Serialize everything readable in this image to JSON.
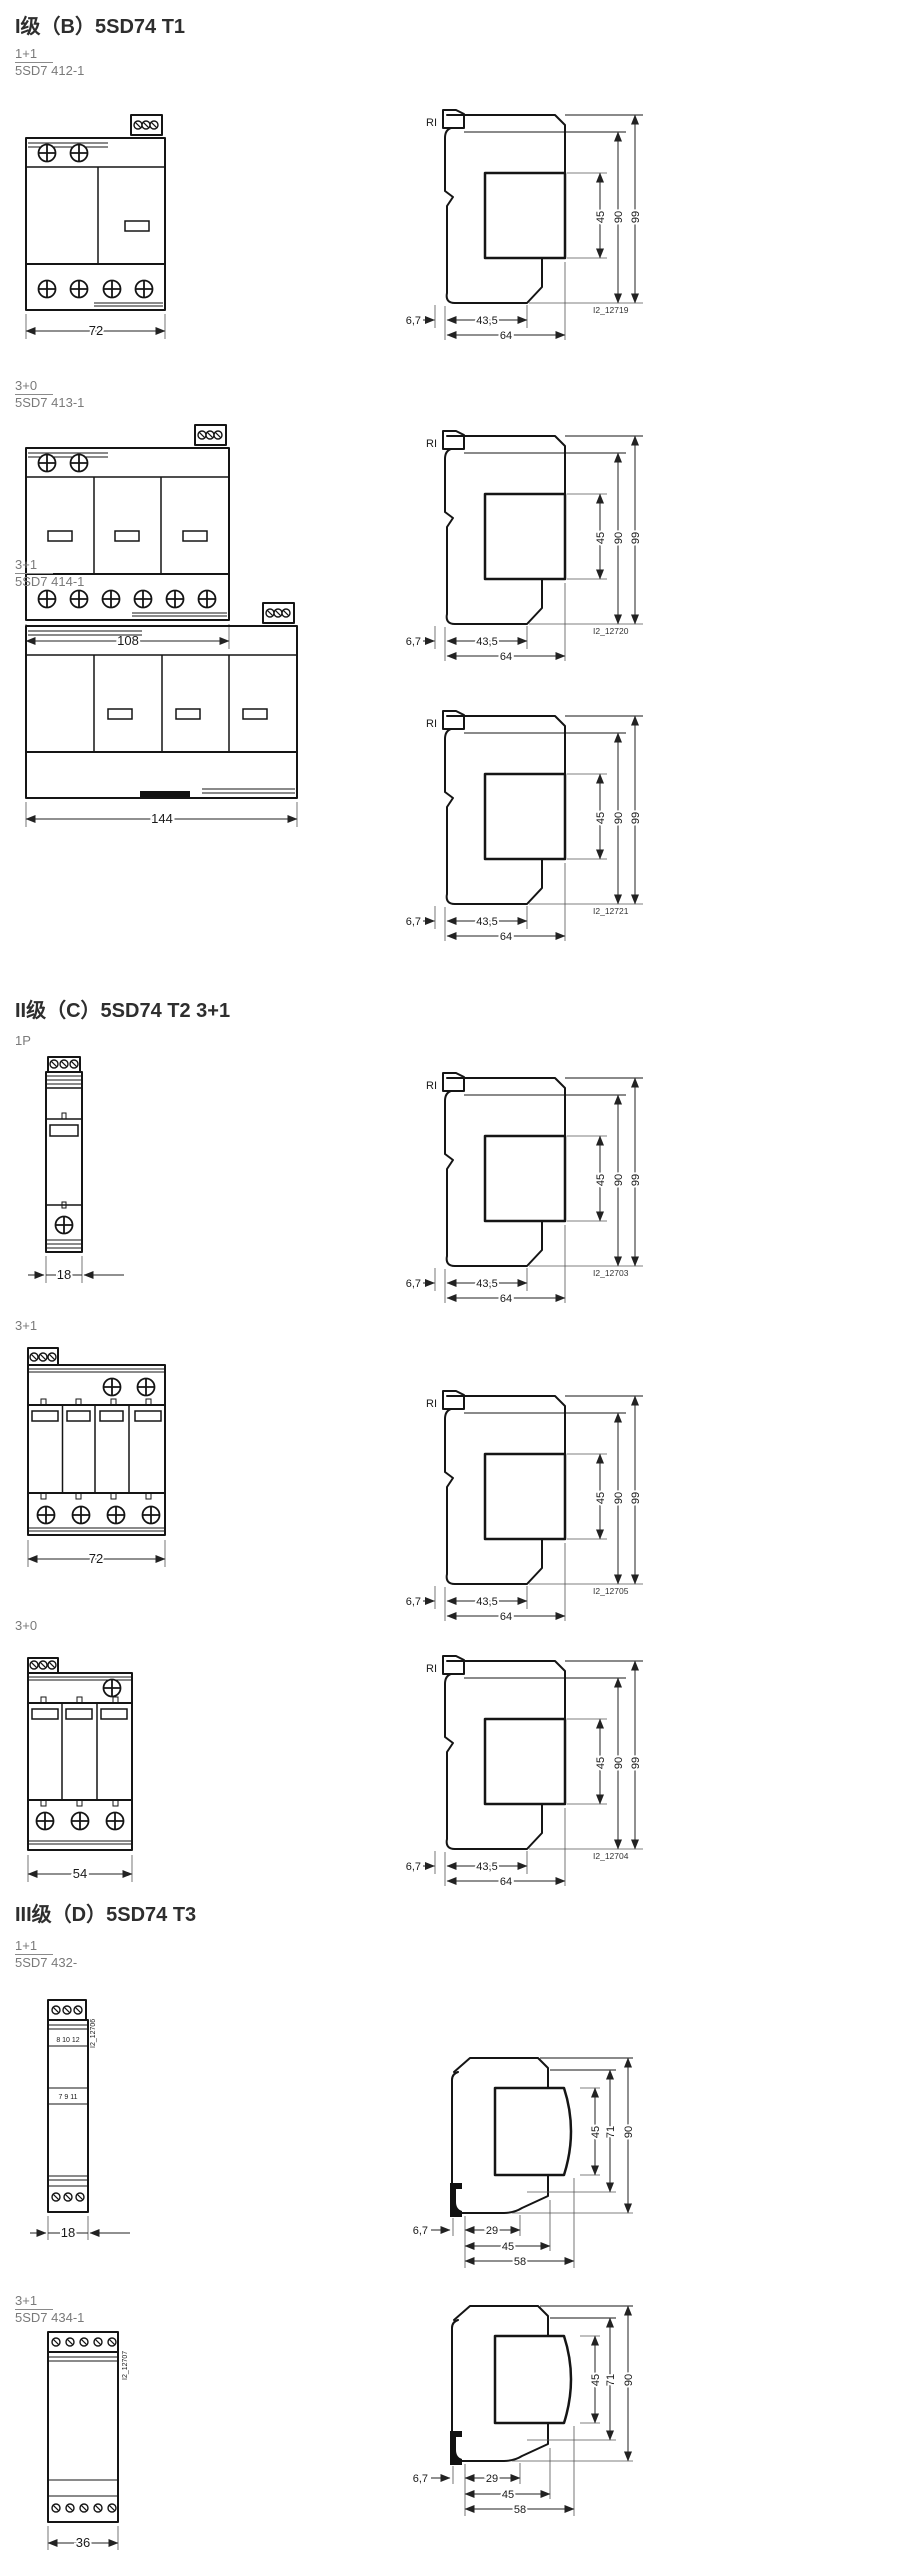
{
  "sections": [
    {
      "heading": "I级（B）5SD74 T1",
      "rows": [
        {
          "variant": "1+1",
          "model": "5SD7 412-1",
          "front": {
            "width": "72"
          },
          "side": {
            "rail": "RI",
            "v": [
              "45",
              "90",
              "99"
            ],
            "h": [
              "6,7",
              "43,5",
              "64"
            ],
            "id": "I2_12719"
          }
        },
        {
          "variant": "3+0",
          "model": "5SD7 413-1",
          "front": {
            "width": "108"
          },
          "side": {
            "rail": "RI",
            "v": [
              "45",
              "90",
              "99"
            ],
            "h": [
              "6,7",
              "43,5",
              "64"
            ],
            "id": "I2_12720"
          }
        },
        {
          "variant": "3+1",
          "model": "5SD7 414-1",
          "front": {
            "width": "144"
          },
          "side": {
            "rail": "RI",
            "v": [
              "45",
              "90",
              "99"
            ],
            "h": [
              "6,7",
              "43,5",
              "64"
            ],
            "id": "I2_12721"
          }
        }
      ]
    },
    {
      "heading": "II级（C）5SD74 T2 3+1",
      "rows": [
        {
          "variant": "1P",
          "front": {
            "width": "18"
          },
          "side": {
            "rail": "RI",
            "v": [
              "45",
              "90",
              "99"
            ],
            "h": [
              "6,7",
              "43,5",
              "64"
            ],
            "id": "I2_12703"
          }
        },
        {
          "variant": "3+1",
          "front": {
            "width": "72"
          },
          "side": {
            "rail": "RI",
            "v": [
              "45",
              "90",
              "99"
            ],
            "h": [
              "6,7",
              "43,5",
              "64"
            ],
            "id": "I2_12705"
          }
        },
        {
          "variant": "3+0",
          "front": {
            "width": "54"
          },
          "side": {
            "rail": "RI",
            "v": [
              "45",
              "90",
              "99"
            ],
            "h": [
              "6,7",
              "43,5",
              "64"
            ],
            "id": "I2_12704"
          }
        }
      ]
    },
    {
      "heading": "III级（D）5SD74 T3",
      "rows": [
        {
          "variant": "1+1",
          "model": "5SD7 432-",
          "front": {
            "width": "18",
            "terminals_top": "8 10 12",
            "terminals_bottom": "7 9 11",
            "id": "I2_12706"
          },
          "side": {
            "v": [
              "45",
              "71",
              "90"
            ],
            "h": [
              "6,7",
              "29",
              "45",
              "58"
            ]
          }
        },
        {
          "variant": "3+1",
          "model": "5SD7 434-1",
          "front": {
            "width": "36",
            "id": "I2_12707"
          },
          "side": {
            "v": [
              "45",
              "71",
              "90"
            ],
            "h": [
              "6,7",
              "29",
              "45",
              "58"
            ]
          }
        }
      ]
    }
  ]
}
